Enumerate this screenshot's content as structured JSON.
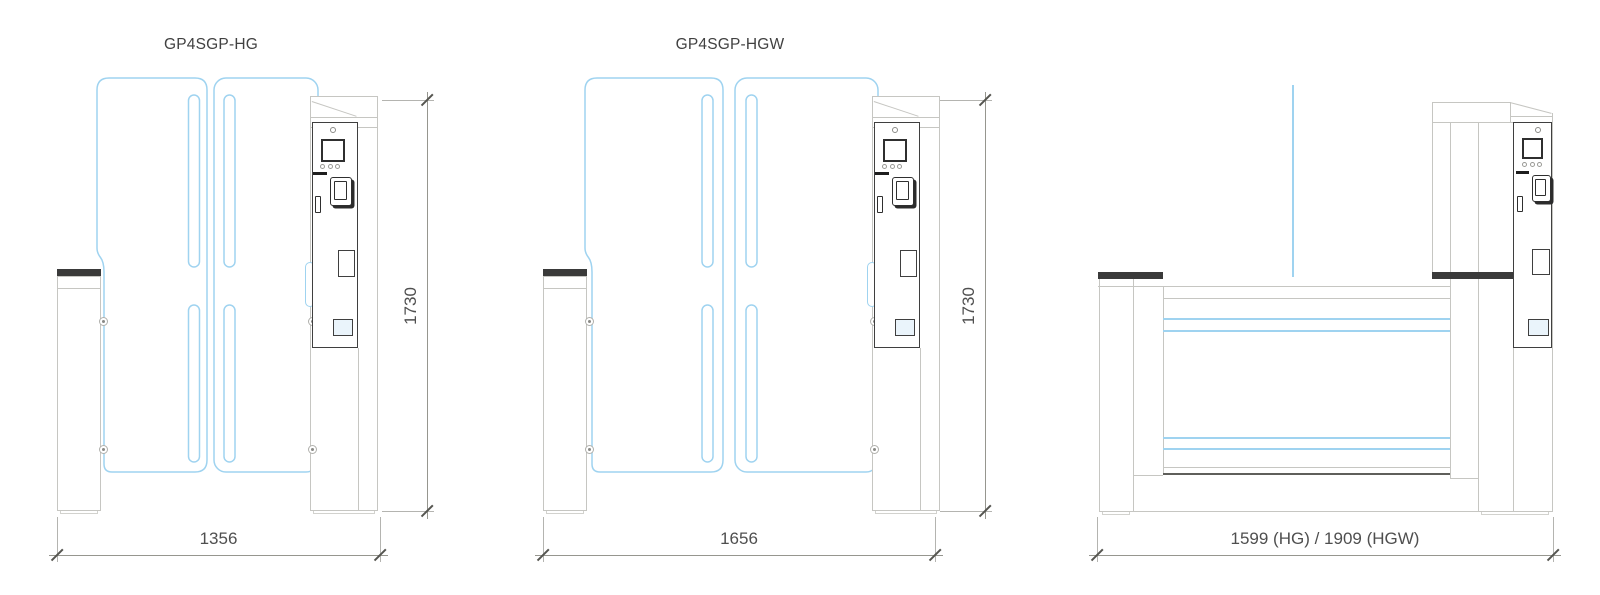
{
  "colors": {
    "glass": "#9fd3f0",
    "structure": "#c6c6c2",
    "structure_medium": "#9a9a96",
    "panel_border": "#3f3f3f",
    "device": "#2f2f2f",
    "band": "#3a3a3a",
    "dim_line": "#96968f",
    "dim_ext": "#b4b4b0",
    "dim_tick": "#555550",
    "dim_text": "#4f4f4f",
    "title_text": "#414141",
    "hatch_fill": "#eaf4fb"
  },
  "drawings": {
    "hg": {
      "title": "GP4SGP-HG",
      "width_label": "1356",
      "height_label": "1730"
    },
    "hgw": {
      "title": "GP4SGP-HGW",
      "width_label": "1656",
      "height_label": "1730"
    },
    "front": {
      "width_label": "1599 (HG) / 1909 (HGW)"
    }
  },
  "device_icons": [
    "status-indicator",
    "display-screen",
    "led-indicators",
    "card-slot-bar",
    "card-reader",
    "key-switch",
    "service-hatch",
    "floor-hatch",
    "glass-bolt"
  ]
}
